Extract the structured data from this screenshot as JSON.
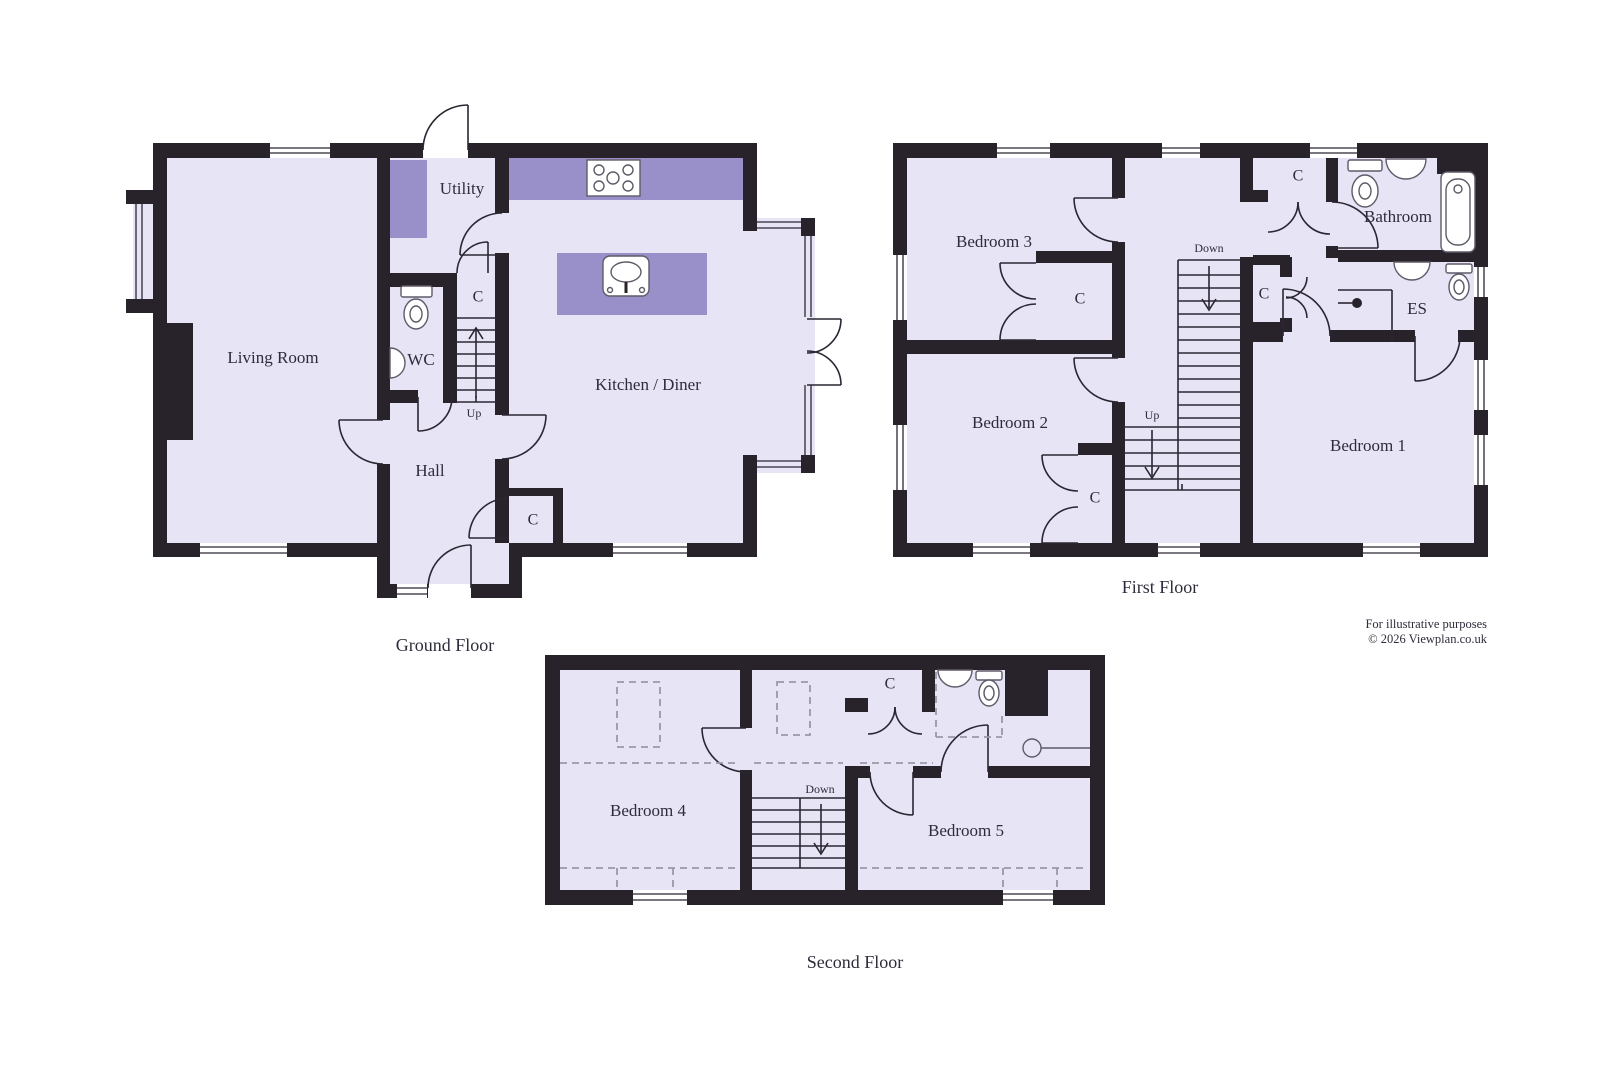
{
  "colors": {
    "wall": "#28222b",
    "floor": "#e7e4f6",
    "accent": "#9a90c9"
  },
  "ground": {
    "title": "Ground Floor",
    "rooms": {
      "living": "Living Room",
      "utility": "Utility",
      "wc": "WC",
      "hall": "Hall",
      "kitchen": "Kitchen / Diner"
    },
    "closet_stairs": "C",
    "closet_hall": "C",
    "stairs_up": "Up"
  },
  "first": {
    "title": "First Floor",
    "rooms": {
      "bedroom1": "Bedroom 1",
      "bedroom2": "Bedroom 2",
      "bedroom3": "Bedroom 3",
      "bathroom": "Bathroom",
      "ensuite": "ES"
    },
    "closets": {
      "top": "C",
      "middle": "C",
      "bedroom3": "C",
      "bedroom2": "C"
    },
    "stairs_down": "Down",
    "stairs_up": "Up"
  },
  "second": {
    "title": "Second Floor",
    "rooms": {
      "bedroom4": "Bedroom 4",
      "bedroom5": "Bedroom 5"
    },
    "closet": "C",
    "stairs_down": "Down"
  },
  "footer": {
    "line1": "For illustrative purposes",
    "line2": "© 2026 Viewplan.co.uk"
  }
}
